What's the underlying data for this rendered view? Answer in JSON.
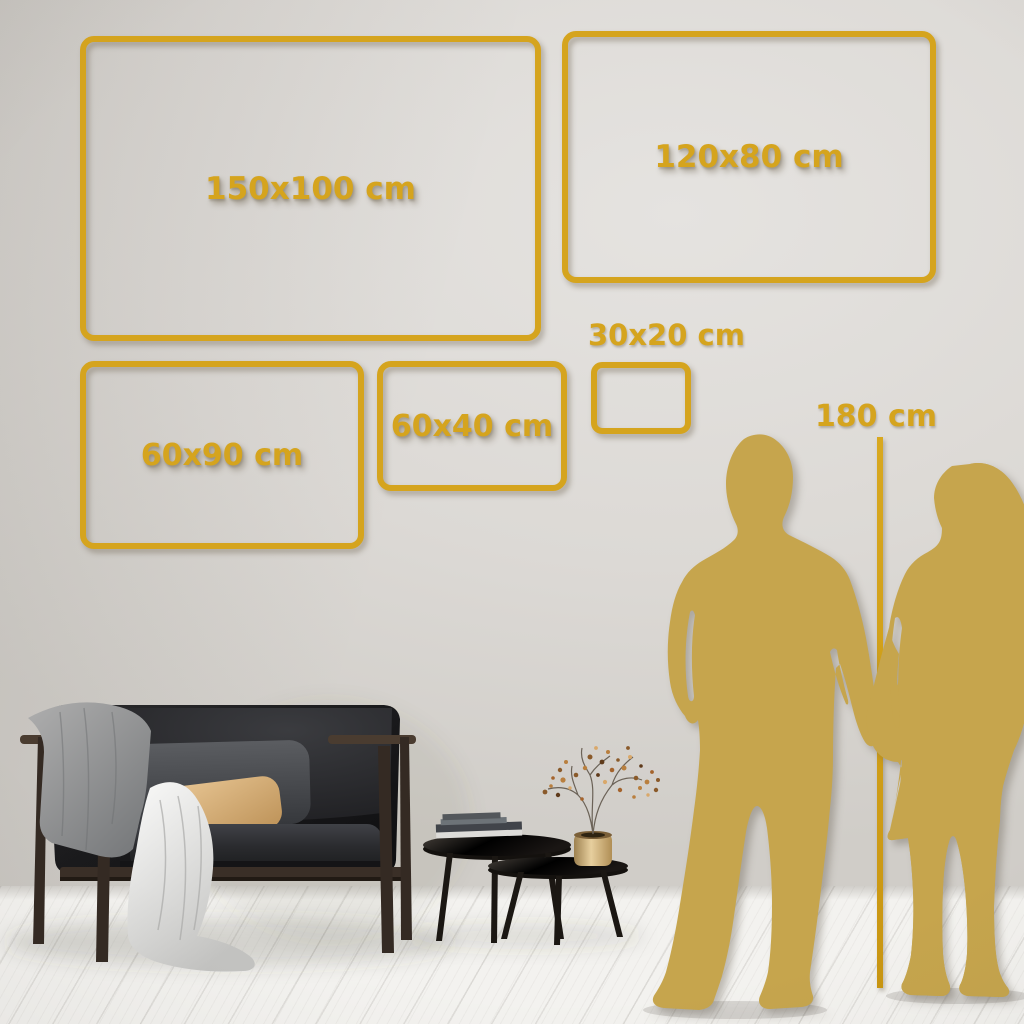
{
  "colors": {
    "frame_gold": "#D5A41E",
    "silhouette_gold": "#C6A54D",
    "wall": "#DCD9D5",
    "floor": "#F3F2EF"
  },
  "size_frames": [
    {
      "id": "150x100",
      "label": "150x100 cm"
    },
    {
      "id": "120x80",
      "label": "120x80 cm"
    },
    {
      "id": "60x90",
      "label": "60x90 cm"
    },
    {
      "id": "60x40",
      "label": "60x40 cm"
    },
    {
      "id": "30x20",
      "label": "30x20 cm"
    }
  ],
  "height_measure": {
    "label": "180 cm"
  },
  "decor_items": [
    "sofa",
    "gray-blanket",
    "white-throw",
    "back-cushion",
    "tan-pillow",
    "coffee-table-large",
    "coffee-table-small",
    "books-stack",
    "brass-vase",
    "dried-branch",
    "man-silhouette",
    "woman-silhouette",
    "wood-plank-floor"
  ]
}
